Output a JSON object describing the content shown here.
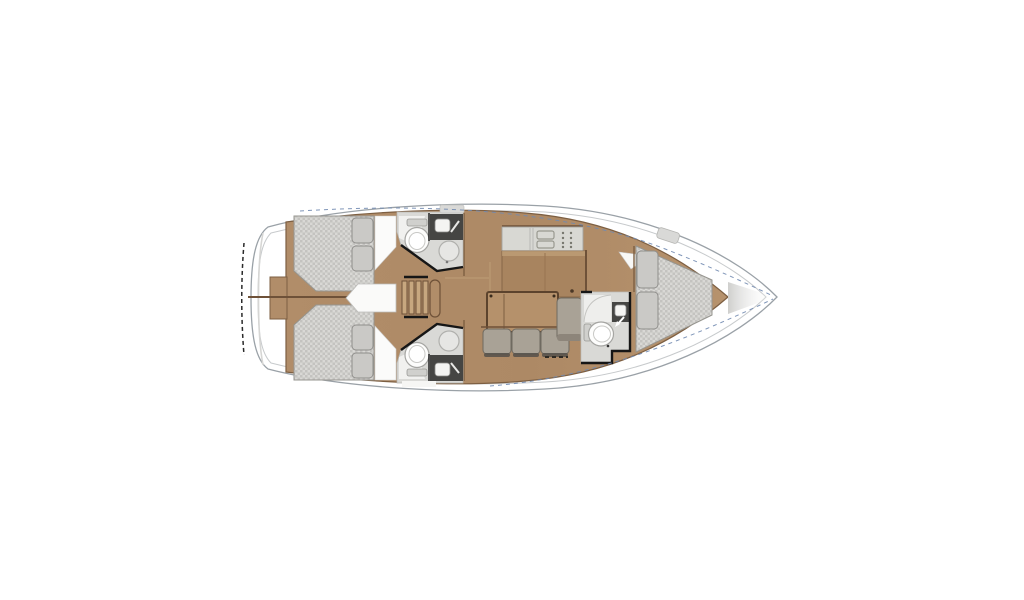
{
  "diagram": {
    "type": "yacht-interior-floor-plan",
    "orientation": "bow-right-stern-left",
    "icons": [
      "double-berth-icon",
      "pillow-icon",
      "toilet-icon",
      "sink-basin-icon",
      "faucet-icon",
      "shower-circle-icon",
      "stove-burners-icon",
      "galley-sink-icon",
      "companionway-stairs-icon",
      "salon-table-icon",
      "sofa-cushion-icon",
      "deck-hatch-icon"
    ]
  },
  "colors": {
    "deck_white": "#ffffff",
    "hull_outline": "#9aa1a7",
    "hull_inner_line": "#c7cacc",
    "transom_dash": "#2a2a2a",
    "sheer_dash_blue": "#7189b0",
    "wood_floor": "#b18d69",
    "wood_cabinet": "#a8845f",
    "wood_light": "#c7a77f",
    "wood_edge": "#7d5f42",
    "wall_black": "#161616",
    "mattress_base": "#d9d8d5",
    "mattress_check": "#c4c3c0",
    "mattress_edge": "#96958f",
    "pillow_fill": "#cac9c6",
    "pillow_edge": "#8f8e8b",
    "bath_floor": "#d9d9d6",
    "shower_white": "#f1f1ef",
    "porcelain": "#fdfdfc",
    "porcelain_edge": "#a5a5a2",
    "fixture_dark": "#454543",
    "basin_white": "#f4f4f2",
    "counter_top": "#d8d8d3",
    "counter_edge": "#a5a5a0",
    "cushion_fill": "#a9a296",
    "cushion_edge": "#6f6a60",
    "cushion_shadow": "#55504a",
    "table_fill": "#b5916b",
    "table_edge": "#5c432d",
    "hatch_fill": "#d9d9d7"
  }
}
